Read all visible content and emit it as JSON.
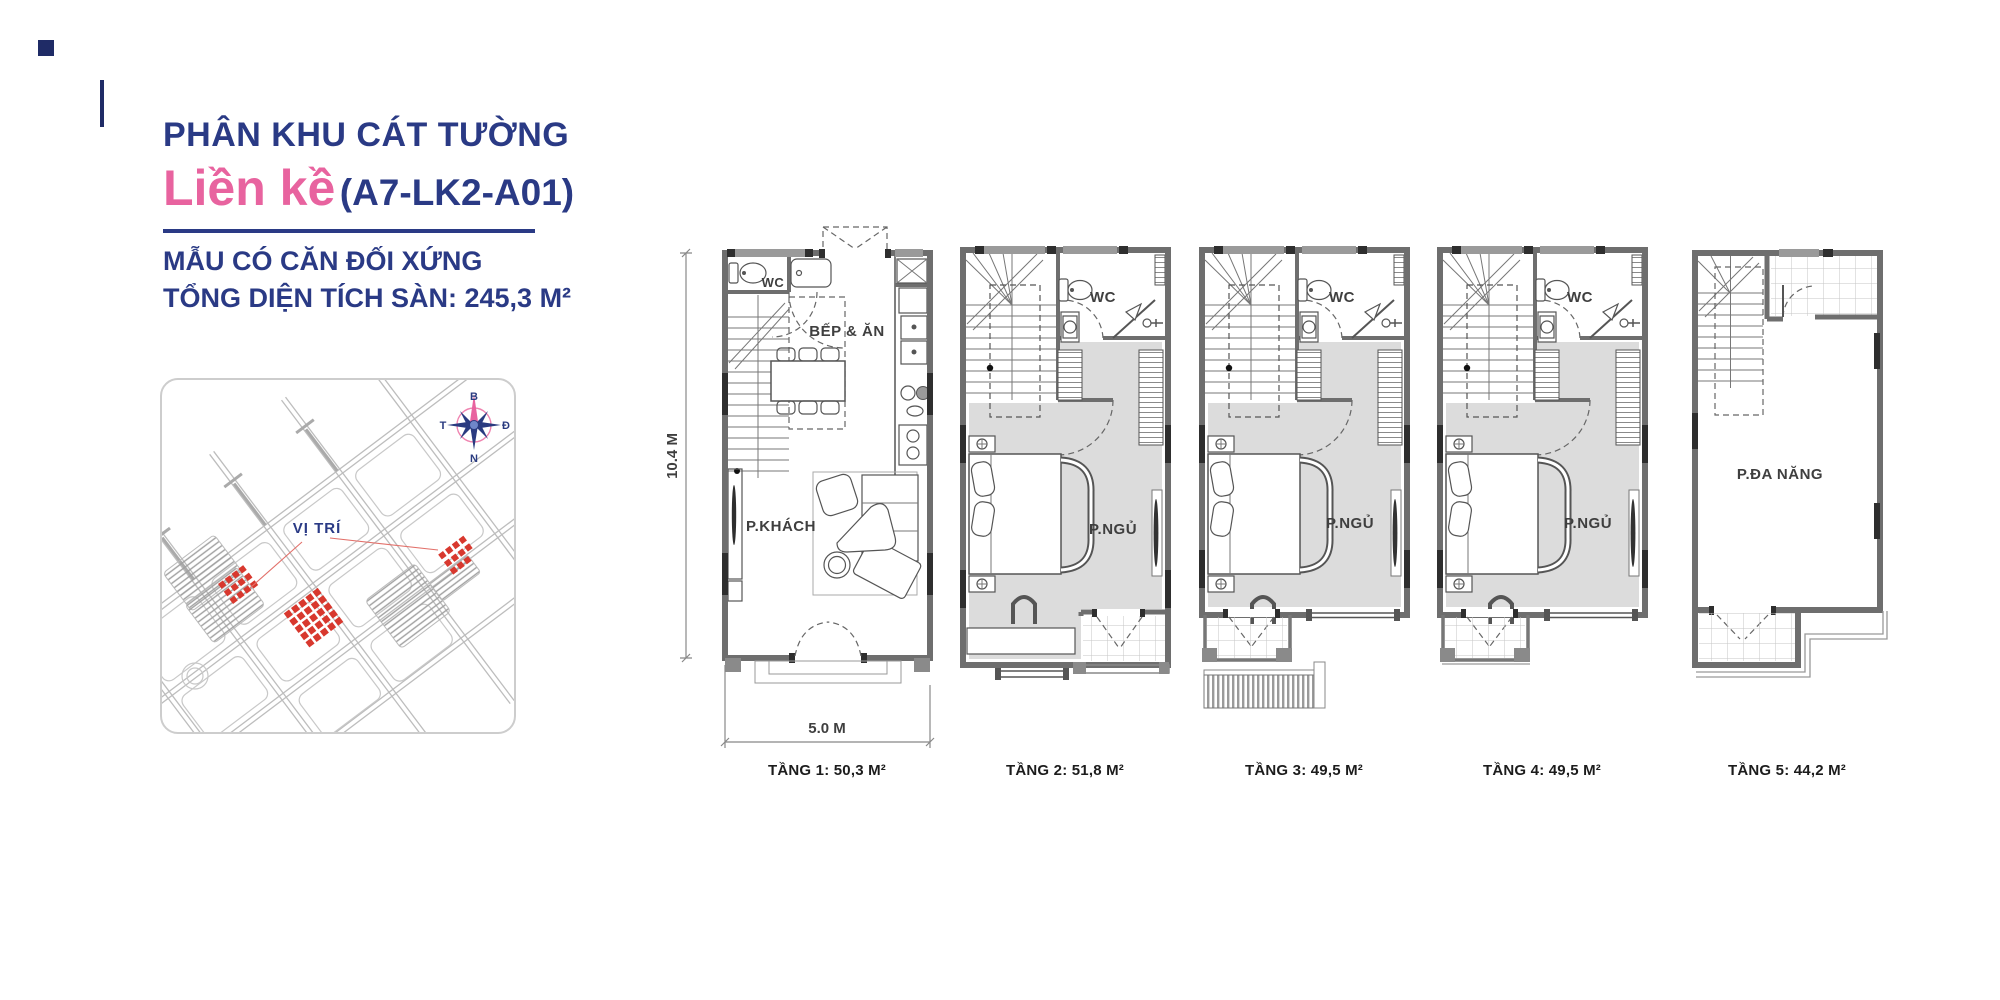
{
  "header": {
    "title": "PHÂN KHU CÁT TƯỜNG",
    "subtitle_highlight": "Liền kề",
    "unit_code": "(A7-LK2-A01)",
    "line1": "MẪU CÓ CĂN ĐỐI XỨNG",
    "line2": "TỔNG DIỆN TÍCH SÀN: 245,3 M²"
  },
  "site_map": {
    "location_label": "VỊ TRÍ",
    "compass": {
      "north": "B",
      "east": "Đ",
      "south": "N",
      "west": "T"
    }
  },
  "dimensions": {
    "depth": "10.4 M",
    "width": "5.0 M"
  },
  "floors": [
    {
      "caption": "TẦNG 1: 50,3 M²",
      "rooms": {
        "wc": "WC",
        "kitchen_dining": "BẾP & ĂN",
        "living": "P.KHÁCH"
      }
    },
    {
      "caption": "TẦNG 2: 51,8 M²",
      "rooms": {
        "wc": "WC",
        "bedroom": "P.NGỦ"
      }
    },
    {
      "caption": "TẦNG 3: 49,5 M²",
      "rooms": {
        "wc": "WC",
        "bedroom": "P.NGỦ"
      }
    },
    {
      "caption": "TẦNG 4: 49,5 M²",
      "rooms": {
        "wc": "WC",
        "bedroom": "P.NGỦ"
      }
    },
    {
      "caption": "TẦNG 5: 44,2 M²",
      "rooms": {
        "multipurpose": "P.ĐA NĂNG"
      }
    }
  ],
  "colors": {
    "navy": "#2a3a85",
    "pink": "#e8639f",
    "map_red": "#d8382e",
    "wall_gray": "#6e6e6e",
    "room_fill": "#dcdcdc"
  }
}
